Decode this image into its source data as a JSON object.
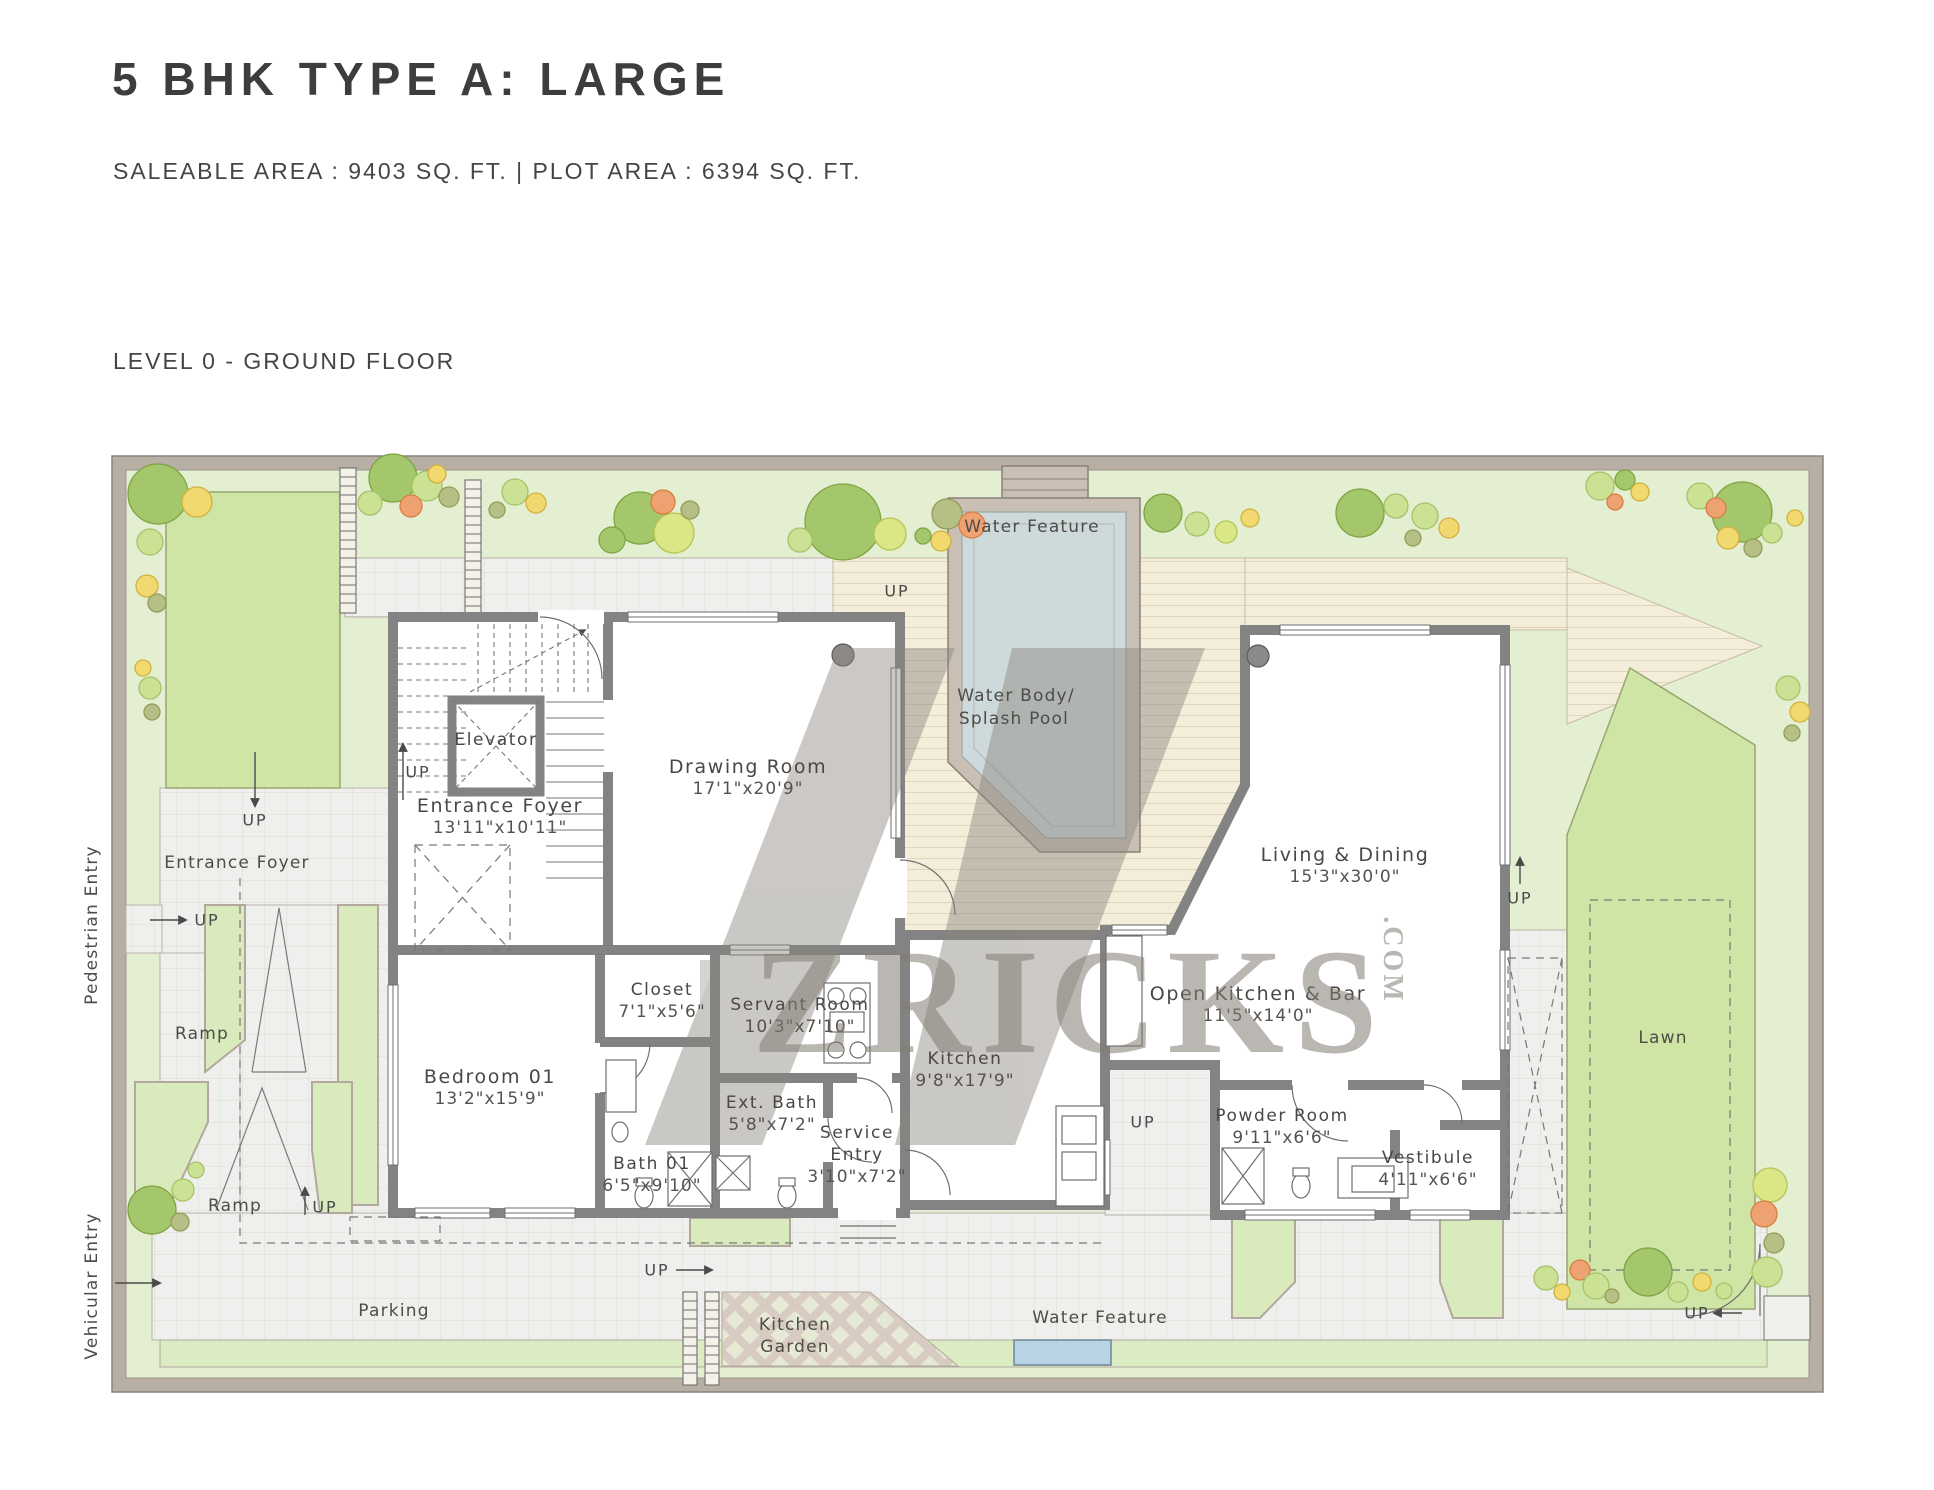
{
  "header": {
    "title": "5 BHK TYPE A: LARGE",
    "area_info": "SALEABLE AREA : 9403 SQ. FT.   |   PLOT AREA : 6394 SQ. FT.",
    "level_label": "LEVEL 0 - GROUND FLOOR"
  },
  "watermark": {
    "brand": "ZRICKS",
    "suffix": ".COM"
  },
  "rooms": [
    {
      "name": "Elevator",
      "dims": ""
    },
    {
      "name": "Entrance Foyer",
      "dims": "13'11\"x10'11\""
    },
    {
      "name": "Drawing Room",
      "dims": "17'1\"x20'9\""
    },
    {
      "name": "Living & Dining",
      "dims": "15'3\"x30'0\""
    },
    {
      "name": "Open Kitchen & Bar",
      "dims": "11'5\"x14'0\""
    },
    {
      "name": "Closet",
      "dims": "7'1\"x5'6\""
    },
    {
      "name": "Servant Room",
      "dims": "10'3\"x7'10\""
    },
    {
      "name": "Kitchen",
      "dims": "9'8\"x17'9\""
    },
    {
      "name": "Bedroom 01",
      "dims": "13'2\"x15'9\""
    },
    {
      "name": "Bath 01",
      "dims": "6'5\"x9'10\""
    },
    {
      "name": "Ext. Bath",
      "dims": "5'8\"x7'2\""
    },
    {
      "name": "Powder Room",
      "dims": "9'11\"x6'6\""
    },
    {
      "name": "Vestibule",
      "dims": "4'11\"x6'6\""
    }
  ],
  "service_entry": {
    "line1": "Service",
    "line2": "Entry",
    "dims": "3'10\"x7'2\""
  },
  "labels": {
    "water_feature": "Water Feature",
    "water_body_line1": "Water Body/",
    "water_body_line2": "Splash Pool",
    "lawn": "Lawn",
    "parking": "Parking",
    "kitchen_garden_line1": "Kitchen",
    "kitchen_garden_line2": "Garden",
    "entrance_foyer_outside": "Entrance Foyer",
    "pedestrian_entry": "Pedestrian Entry",
    "vehicular_entry": "Vehicular Entry",
    "ramp": "Ramp",
    "up": "UP"
  }
}
